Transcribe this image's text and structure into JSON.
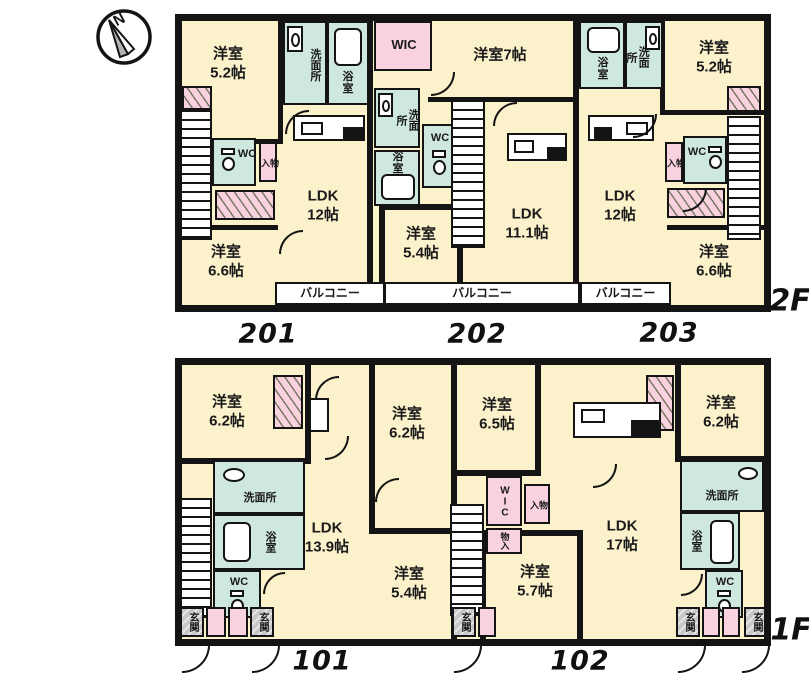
{
  "compass": {
    "north": "N"
  },
  "f2": {
    "label": "2F",
    "units": {
      "u201": "201",
      "u202": "202",
      "u203": "203"
    },
    "balconies": [
      "バルコニー",
      "バルコニー",
      "バルコニー"
    ],
    "rooms": {
      "r201_bed1": "洋室\n5.2帖",
      "r201_wash": "洗面所",
      "r201_bath": "浴室",
      "r201_wc": "WC",
      "r201_st": "物入",
      "r201_ldk": "LDK\n12帖",
      "r201_bed2": "洋室\n6.6帖",
      "r202_wic": "WIC",
      "r202_bed1": "洋室7帖",
      "r202_wash": "洗面所",
      "r202_bath": "浴室",
      "r202_wc": "WC",
      "r202_ldk": "LDK\n11.1帖",
      "r202_bed2": "洋室\n5.4帖",
      "r203_bath": "浴室",
      "r203_wash": "洗面所",
      "r203_bed1": "洋室\n5.2帖",
      "r203_wc": "WC",
      "r203_st": "物入",
      "r203_ldk": "LDK\n12帖",
      "r203_bed2": "洋室\n6.6帖"
    }
  },
  "f1": {
    "label": "1F",
    "units": {
      "u101": "101",
      "u102": "102"
    },
    "genkan": [
      "玄関",
      "玄関",
      "玄関",
      "玄関",
      "玄関"
    ],
    "rooms": {
      "r101_bed1": "洋室\n6.2帖",
      "r101_bed2": "洋室\n6.2帖",
      "r101_wash": "洗面所",
      "r101_bath": "浴室",
      "r101_wc": "WC",
      "r101_ldk": "LDK\n13.9帖",
      "r101_bed3": "洋室\n5.4帖",
      "r102_bed1": "洋室\n6.5帖",
      "r102_wic": "WIC",
      "r102_st1": "物入",
      "r102_st2": "物入",
      "r102_ldk": "LDK\n17帖",
      "r102_bed2": "洋室\n5.7帖",
      "r102_bed3": "洋室\n6.2帖",
      "r102_wash": "洗面所",
      "r102_bath": "浴室",
      "r102_wc": "WC"
    }
  },
  "colors": {
    "room_fill": "#fbf2cc",
    "wet_area_fill": "#cfe8de",
    "storage_fill": "#f8d2de",
    "wall": "#141414",
    "entrance_fill": "#c9c9c9"
  }
}
